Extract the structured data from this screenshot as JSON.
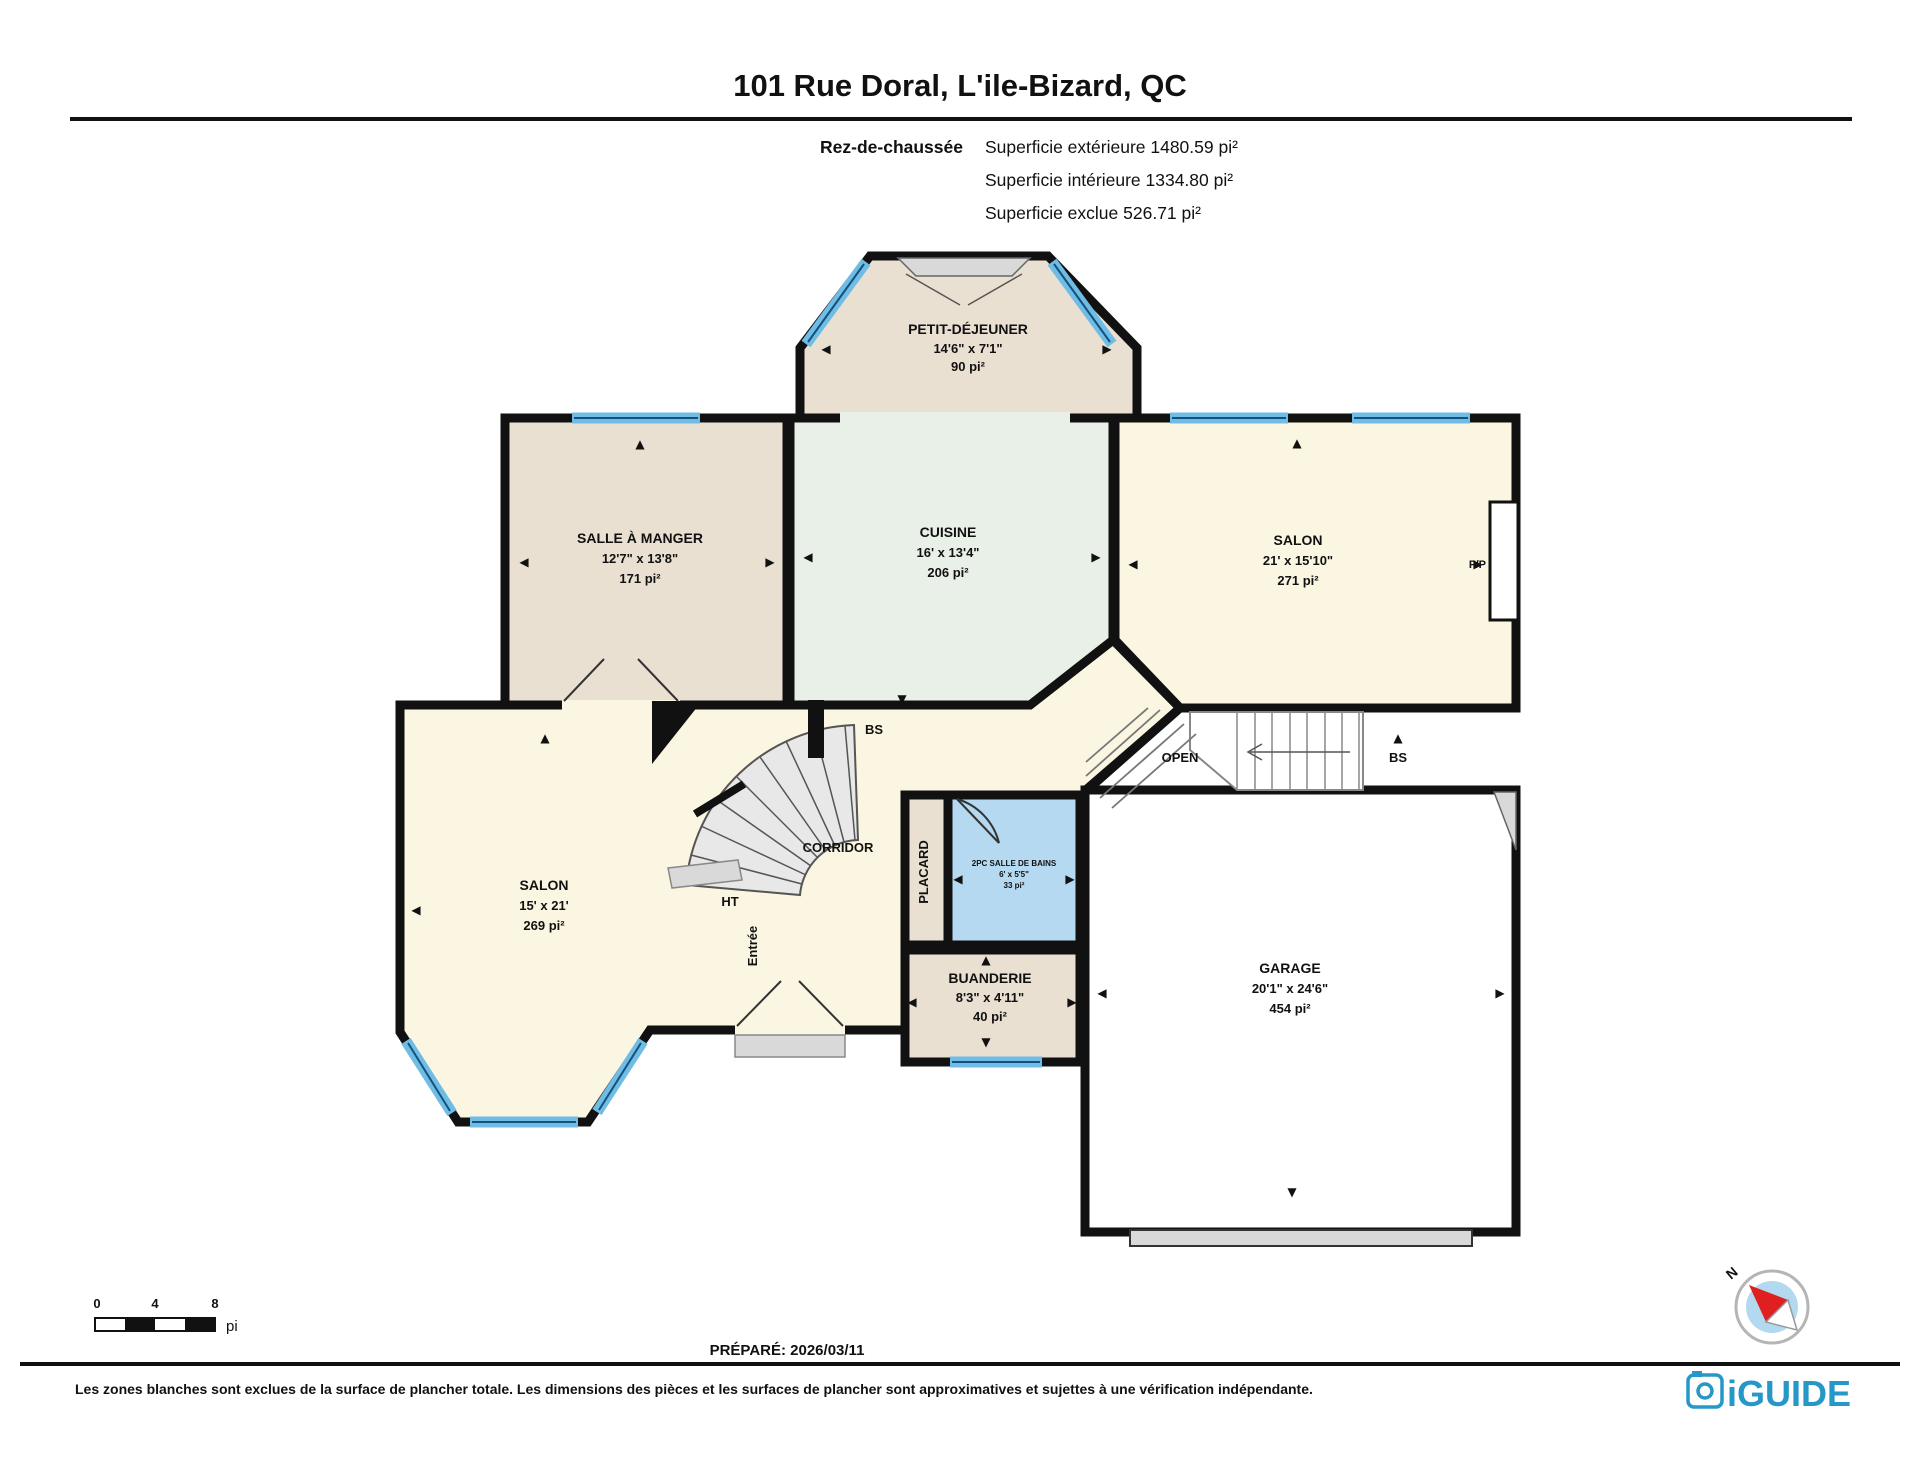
{
  "header": {
    "title": "101 Rue Doral, L'ile-Bizard, QC",
    "floor_label": "Rez-de-chaussée",
    "area_lines": [
      "Superficie extérieure 1480.59 pi²",
      "Superficie intérieure 1334.80 pi²",
      "Superficie exclue 526.71 pi²"
    ]
  },
  "rooms": {
    "breakfast": {
      "name": "PETIT-DÉJEUNER",
      "dims": "14'6\" x 7'1\"",
      "area": "90 pi²"
    },
    "dining": {
      "name": "SALLE À MANGER",
      "dims": "12'7\" x 13'8\"",
      "area": "171 pi²"
    },
    "kitchen": {
      "name": "CUISINE",
      "dims": "16' x 13'4\"",
      "area": "206 pi²"
    },
    "salon_right": {
      "name": "SALON",
      "dims": "21' x 15'10\"",
      "area": "271 pi²"
    },
    "salon_left": {
      "name": "SALON",
      "dims": "15' x 21'",
      "area": "269 pi²"
    },
    "bath": {
      "name": "2PC SALLE DE BAINS",
      "dims": "6' x 5'5\"",
      "area": "33 pi²"
    },
    "laundry": {
      "name": "BUANDERIE",
      "dims": "8'3\" x 4'11\"",
      "area": "40 pi²"
    },
    "garage": {
      "name": "GARAGE",
      "dims": "20'1\" x 24'6\"",
      "area": "454 pi²"
    }
  },
  "labels": {
    "corridor": "CORRIDOR",
    "placard": "PLACARD",
    "entry": "Entrée",
    "ht": "HT",
    "bs_stair": "BS",
    "bs_open": "BS",
    "open": "OPEN",
    "fireplace": "F/P",
    "north": "N"
  },
  "scale": {
    "zero": "0",
    "four": "4",
    "eight": "8",
    "unit": "pi"
  },
  "footer": {
    "prepared": "PRÉPARÉ: 2026/03/11",
    "disclaimer": "Les zones blanches sont exclues de la surface de plancher totale. Les dimensions des pièces et les surfaces de plancher sont approximatives et sujettes à une vérification indépendante.",
    "brand": "iGUIDE"
  },
  "colors": {
    "wall": "#111111",
    "cream": "#fbf6e1",
    "tan": "#e9e0d2",
    "mint": "#e9f0e8",
    "bathblue": "#b5d9f0",
    "windowblue": "#6fbce4",
    "windowline": "#14527d",
    "gray": "#d9d9d9",
    "stair": "#e8e8e8",
    "brand": "#2598c8",
    "compassblue": "#b3d9f0",
    "needle": "#e02020"
  }
}
